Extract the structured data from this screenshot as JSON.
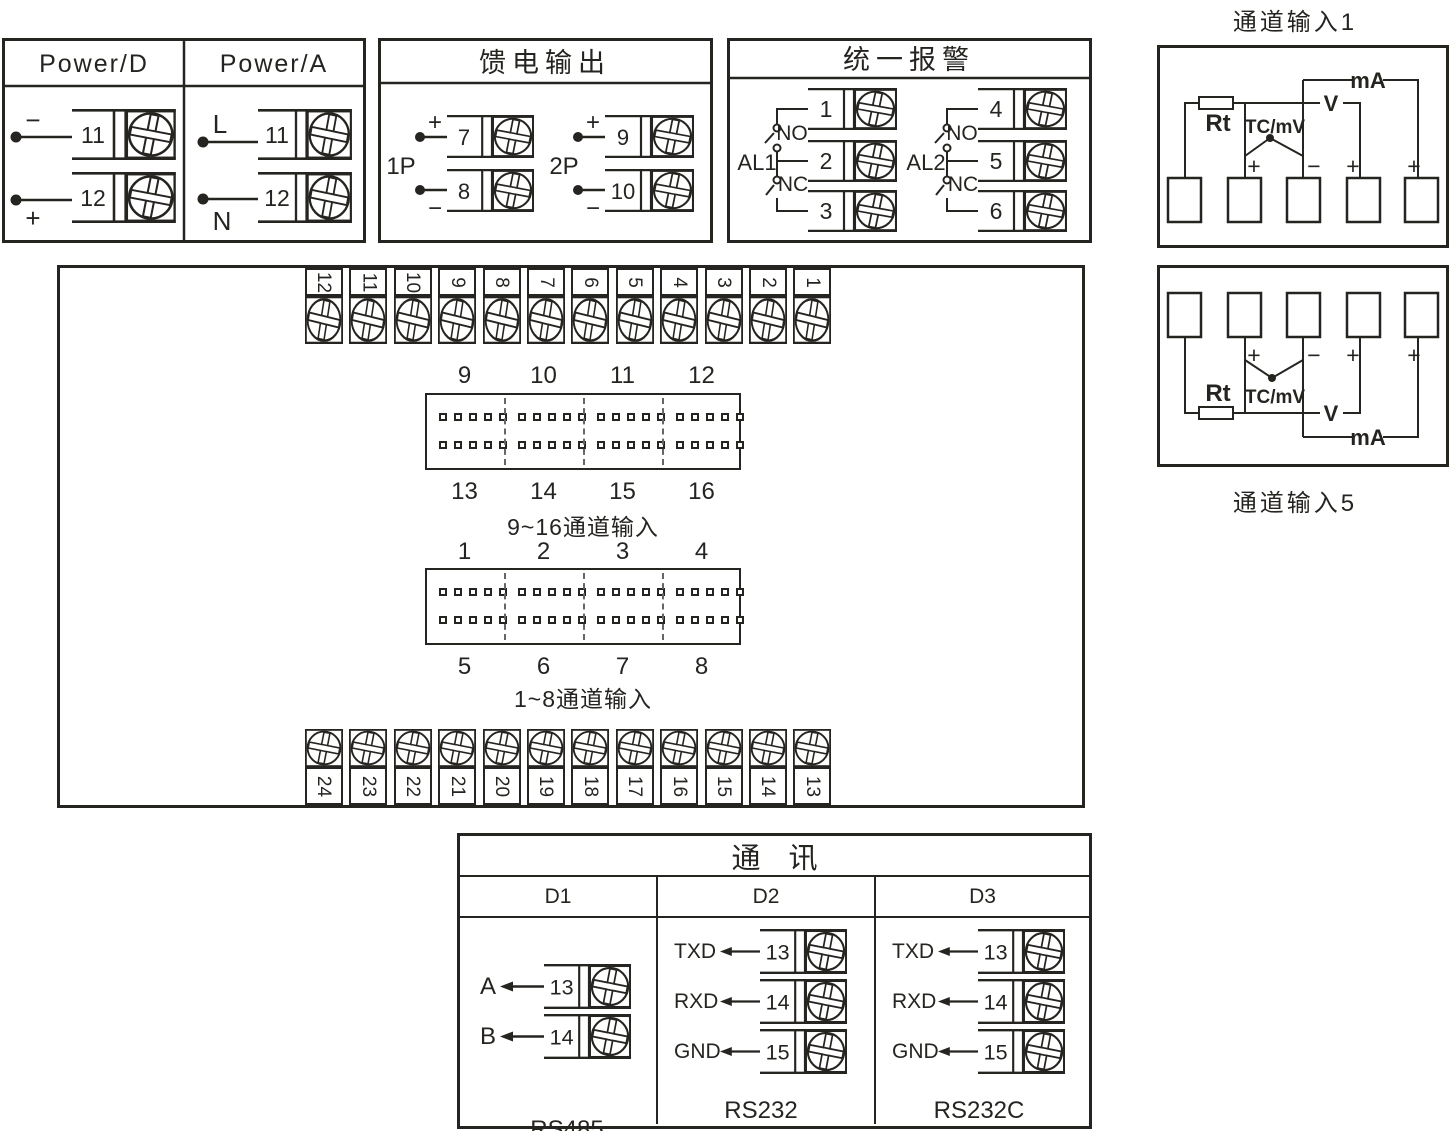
{
  "power": {
    "title_d": "Power/D",
    "title_a": "Power/A",
    "d1_sign": "−",
    "d1_num": "11",
    "d2_sign": "+",
    "d2_num": "12",
    "a1_sign": "L",
    "a1_num": "11",
    "a2_sign": "N",
    "a2_num": "12"
  },
  "feed": {
    "title": "馈电输出",
    "p1": "1P",
    "p2": "2P",
    "t7": "7",
    "t8": "8",
    "t9": "9",
    "t10": "10",
    "plus": "+",
    "minus": "−"
  },
  "alarm": {
    "title": "统一报警",
    "al1": "AL1",
    "al2": "AL2",
    "no": "NO",
    "nc": "NC",
    "t1": "1",
    "t2": "2",
    "t3": "3",
    "t4": "4",
    "t5": "5",
    "t6": "6"
  },
  "ch1": {
    "title": "通道输入1",
    "rt": "Rt",
    "tc": "TC/mV",
    "v": "V",
    "ma": "mA",
    "plus": "+",
    "minus": "−"
  },
  "ch5": {
    "title": "通道输入5",
    "rt": "Rt",
    "tc": "TC/mV",
    "v": "V",
    "ma": "mA",
    "plus": "+",
    "minus": "−"
  },
  "main": {
    "top_terminals": [
      "12",
      "11",
      "10",
      "9",
      "8",
      "7",
      "6",
      "5",
      "4",
      "3",
      "2",
      "1"
    ],
    "bottom_terminals": [
      "24",
      "23",
      "22",
      "21",
      "20",
      "19",
      "18",
      "17",
      "16",
      "15",
      "14",
      "13"
    ],
    "conn916": {
      "top_labels": [
        "9",
        "10",
        "11",
        "12"
      ],
      "bottom_labels": [
        "13",
        "14",
        "15",
        "16"
      ],
      "caption": "9~16通道输入",
      "pin_grid": {
        "groups": 4,
        "per_group": 5,
        "rows": 2
      }
    },
    "conn18": {
      "top_labels": [
        "1",
        "2",
        "3",
        "4"
      ],
      "bottom_labels": [
        "5",
        "6",
        "7",
        "8"
      ],
      "caption": "1~8通道输入",
      "pin_grid": {
        "groups": 4,
        "per_group": 5,
        "rows": 2
      }
    }
  },
  "comm": {
    "title": "通 讯",
    "d1": {
      "header": "D1",
      "standard": "RS485",
      "rows": [
        {
          "label": "A",
          "num": "13"
        },
        {
          "label": "B",
          "num": "14"
        }
      ]
    },
    "d2": {
      "header": "D2",
      "standard": "RS232",
      "rows": [
        {
          "label": "TXD",
          "num": "13"
        },
        {
          "label": "RXD",
          "num": "14"
        },
        {
          "label": "GND",
          "num": "15"
        }
      ]
    },
    "d3": {
      "header": "D3",
      "standard": "RS232C",
      "rows": [
        {
          "label": "TXD",
          "num": "13"
        },
        {
          "label": "RXD",
          "num": "14"
        },
        {
          "label": "GND",
          "num": "15"
        }
      ]
    }
  }
}
